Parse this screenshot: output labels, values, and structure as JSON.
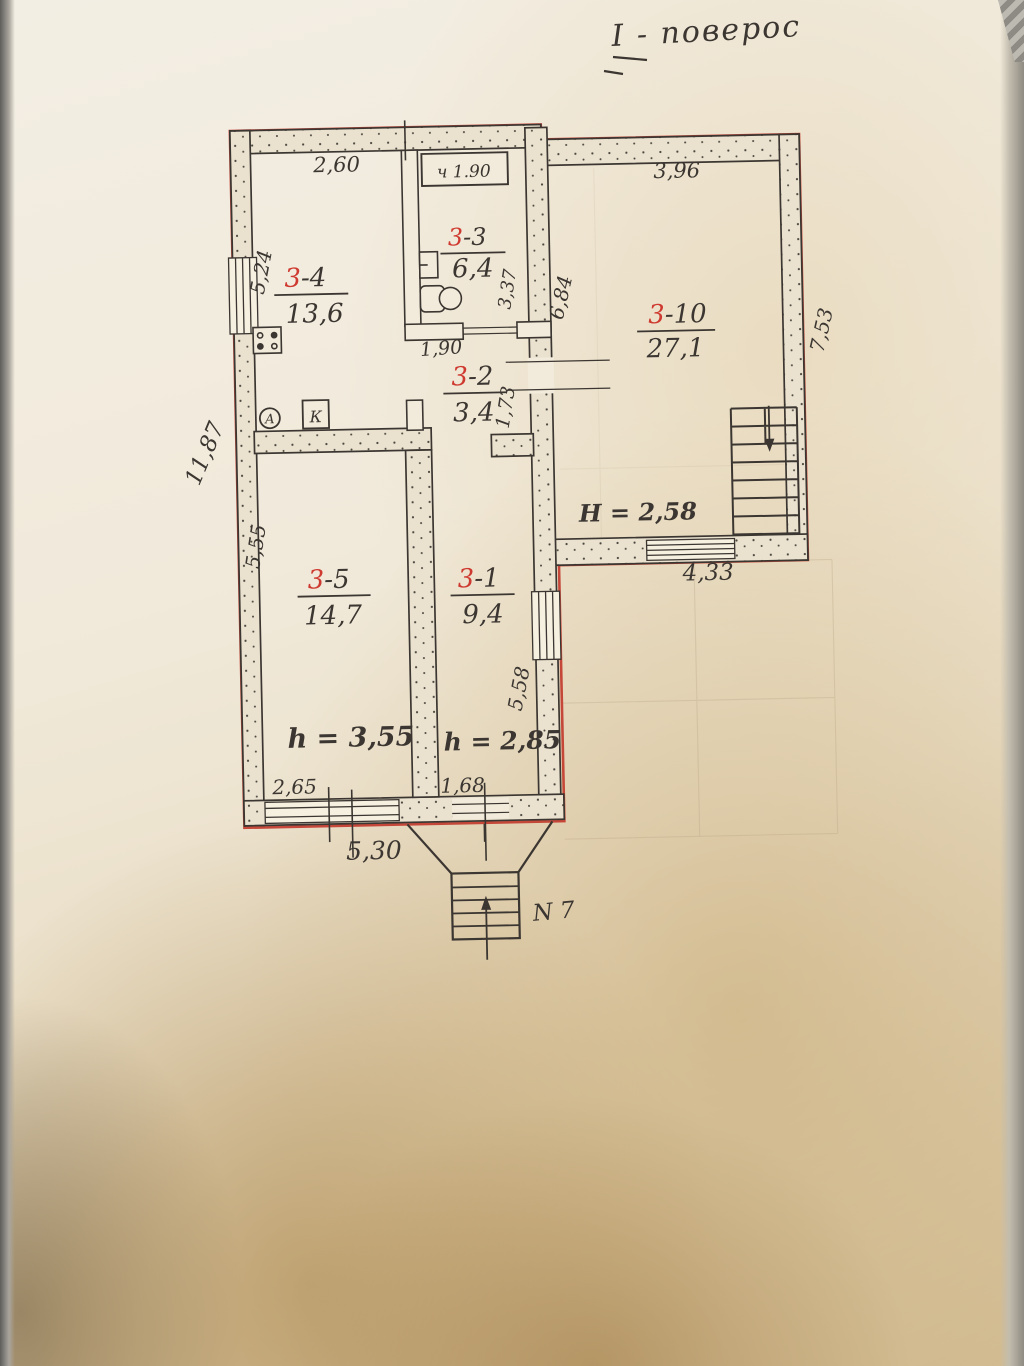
{
  "plan": {
    "title": "І - поверос",
    "rooms": [
      {
        "prefix": "3",
        "suffix": "-4",
        "area": "13,6"
      },
      {
        "prefix": "3",
        "suffix": "-3",
        "area": "6,4"
      },
      {
        "prefix": "3",
        "suffix": "-10",
        "area": "27,1"
      },
      {
        "prefix": "3",
        "suffix": "-2",
        "area": "3,4"
      },
      {
        "prefix": "3",
        "suffix": "-5",
        "area": "14,7"
      },
      {
        "prefix": "3",
        "suffix": "-1",
        "area": "9,4"
      }
    ],
    "dims": {
      "room4_top": "2,60",
      "closet": "ч 1.90",
      "room10_top": "3,96",
      "room4_left": "5,24",
      "outer_left": "11,87",
      "room5_left": "5,55",
      "room3_right": "3,37",
      "room10_left": "6,84",
      "corridor_top": "1,90",
      "corridor_right": "1,73",
      "outer_right": "7,53",
      "notch_bottom": "4,33",
      "room1_right": "5,58",
      "room5_bottom": "2,65",
      "entrance_width": "1,68",
      "bottom_outer": "5,30"
    },
    "heights": {
      "room10": "H = 2,58",
      "room5": "h = 3,55",
      "room1": "h = 2,85"
    },
    "marks": {
      "entrance_stairs": "N 7",
      "k_box": "К",
      "a_circle": "А"
    },
    "colors": {
      "outline": "#c23b2e",
      "pencil": "#3b3631",
      "red_digit": "#cf3a30",
      "blue_ink": "#2a3fa6",
      "paper": "#efe8da"
    }
  }
}
